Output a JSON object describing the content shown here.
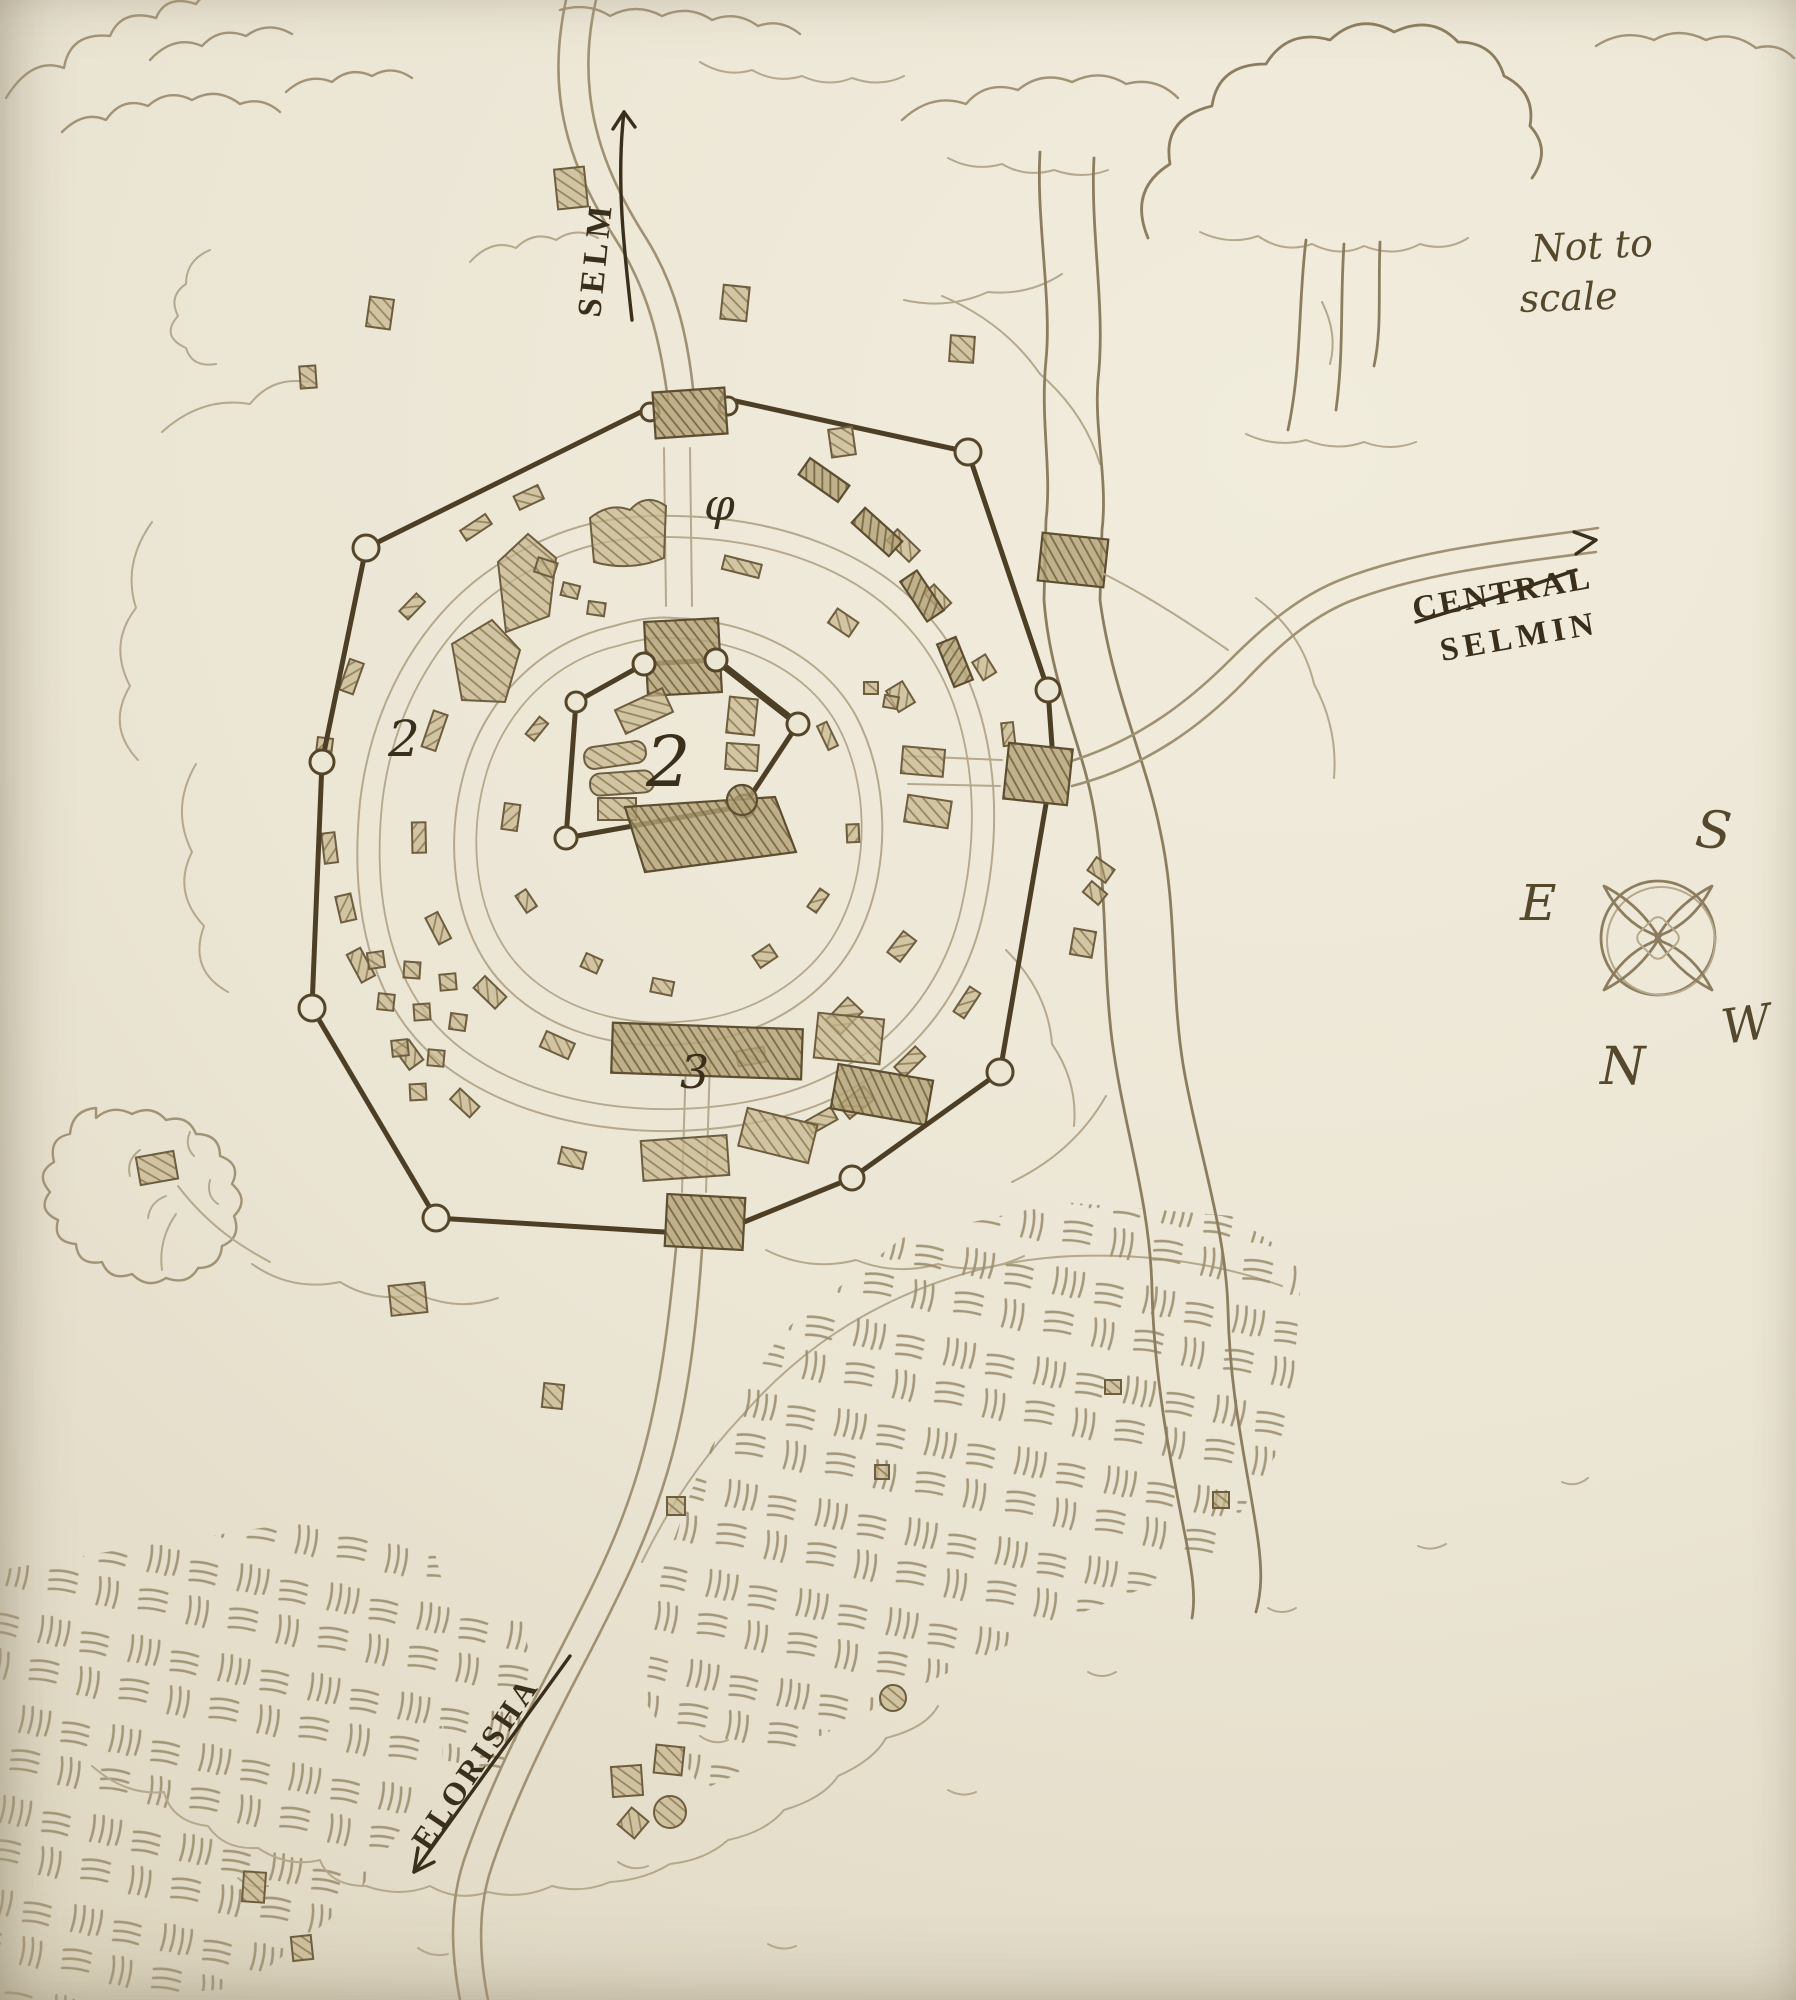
{
  "map": {
    "disclaimer": {
      "line1": "Not to",
      "line2": "scale"
    },
    "road_labels": {
      "north": "SELM",
      "east_line1": "CENTRAL",
      "east_line2": "SELMIN",
      "south": "ELORISHA"
    },
    "compass": {
      "s": "S",
      "e": "E",
      "n": "N",
      "w": "W"
    },
    "district_markers": {
      "center": "2",
      "west": "2",
      "south": "3",
      "north": "φ"
    },
    "colors": {
      "paper": "#ebe5d4",
      "pencil": "#a39376",
      "ink": "#3a2f1b",
      "wall": "#4c3f26",
      "building_fill": "#c3b48c"
    }
  }
}
